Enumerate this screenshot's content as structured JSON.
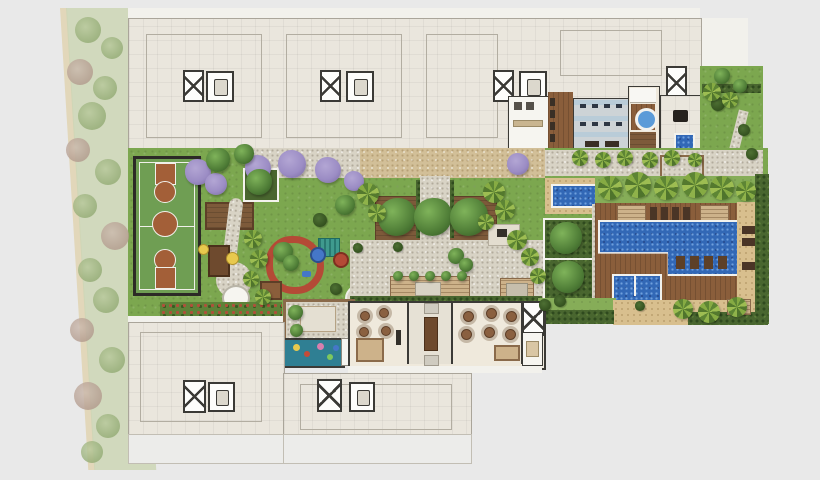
{
  "image_type": "color-rendered condominium implantation site plan, top view, no text labels",
  "palette": {
    "background": "#e9e9e9",
    "sidewalk_paper": "#f2f1ec",
    "tower_floor": "#eae6dd",
    "wall_dark": "#3b3a36",
    "grass": "#7ca74f",
    "hedge": "#49662f",
    "faded_street_green": "#ccd6b5",
    "court_green": "#6f9e53",
    "court_clay": "#a35f38",
    "playground_track_red": "#b44a36",
    "purple_tree": "#9b8cc4",
    "tree_green": "#4e7c36",
    "palm_green": "#86ab43",
    "deck_wood": "#8a5e3b",
    "gravel": "#d8d3c5",
    "tan_gravel": "#d2bf98",
    "sand_deck": "#d8bf8e",
    "pool_blue": "#3268b6",
    "pool_sparkle": "#6fa0dc",
    "kids_room_teal": "#2f7f93",
    "gym_floor": "#cdd3d6"
  },
  "areas": {
    "street": "street landscaping strip",
    "towers_top": "residential tower floor plans (north)",
    "tower_bottom_left": "residential tower floor plan (south-west)",
    "tower_bottom_center": "residential tower floor plan (south)",
    "court": "multi-sport court",
    "pergola": "garden pergola",
    "planter": "hedged tree planter",
    "playground": "kids playground",
    "play_track": "playground red track",
    "orchard": "orchard wood deck",
    "central_path": "central gravel path",
    "courtyard": "central courtyard",
    "stone_patio": "decorative stone patio",
    "kids_playroom": "kids playroom",
    "lounge": "lounge room",
    "lobby": "entrance lobby",
    "party_hall": "party hall",
    "stair": "stair core",
    "lockers": "changing rooms",
    "gym": "fitness room",
    "spa": "spa with jacuzzi",
    "sauna": "sauna",
    "massage": "massage room",
    "plunge_pool": "plunge pool",
    "tr_garden": "reading garden",
    "tr_plaza": "stone plaza",
    "lap_pool": "lap pool / spa pool",
    "garden_rooms": "hedged garden rooms",
    "sun_deck": "pool wood sun deck",
    "main_pool": "main swimming pool",
    "kids_pool": "kids pool",
    "deck_loungers": "sun loungers",
    "gazebo": "gazebo",
    "flower_bed": "flower bed",
    "perimeter_hedge": "perimeter hedge",
    "bbq": "picnic / barbecue table",
    "play_pavilion": "playground pavilion"
  }
}
